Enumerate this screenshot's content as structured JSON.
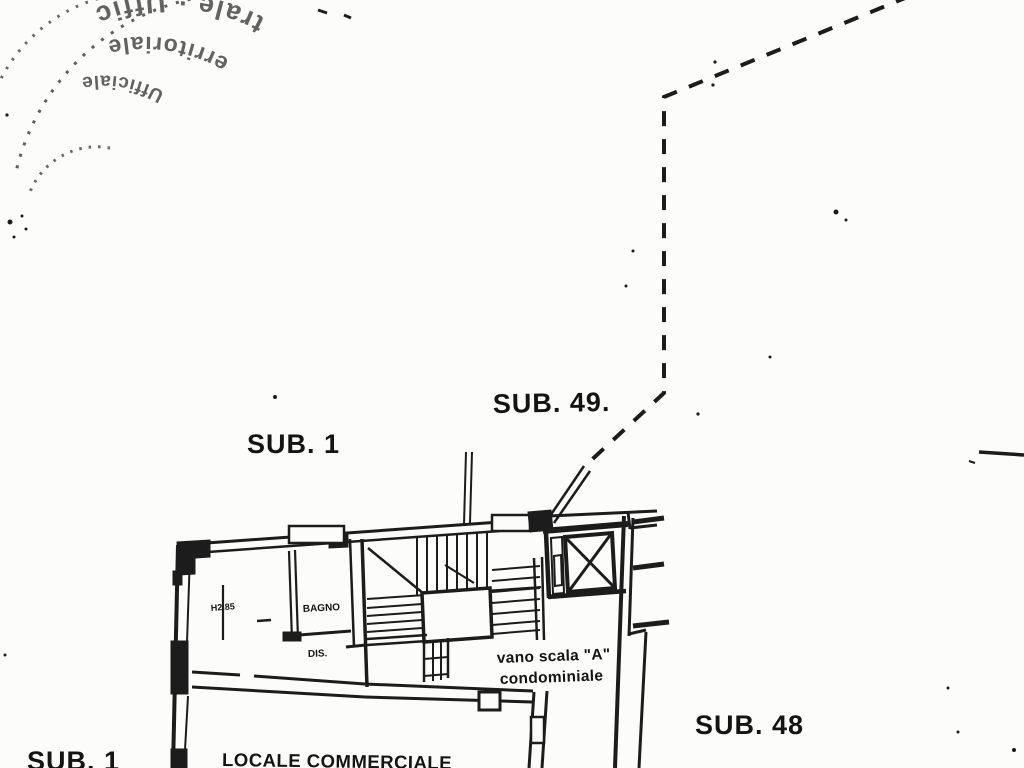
{
  "colors": {
    "paper": "#fcfcfa",
    "ink": "#1c1c1c"
  },
  "stamp": {
    "ring_outer_fragment": "trale · Uffic",
    "ring_middle_fragment": "erritoriale",
    "ring_inner_fragment": "Ufficiale"
  },
  "units": {
    "sub49": "SUB. 49.",
    "sub1_upper": "SUB. 1",
    "sub48": "SUB. 48",
    "sub1_lower": "SUB. 1"
  },
  "rooms": {
    "locale": "LOCALE COMMERCIALE",
    "bagno": "BAGNO",
    "dis": "DIS.",
    "height_note": "H2.85",
    "vano_line1": "vano scala \"A\"",
    "vano_line2": "condominiale"
  }
}
